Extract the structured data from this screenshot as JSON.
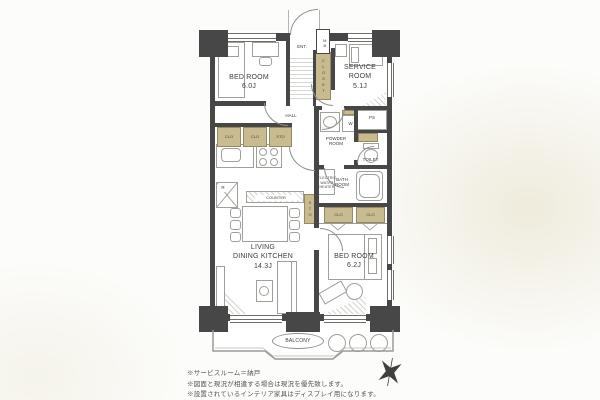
{
  "colors": {
    "wall": "#474747",
    "closet_fill": "#c8bb90",
    "accent_hatch": "#d4d4cf"
  },
  "rooms": {
    "bedroom_top": {
      "label": "BED ROOM",
      "size": "6.0J"
    },
    "service_room": {
      "label": "SERVICE\nROOM",
      "size": "5.1J"
    },
    "ldk": {
      "label": "LIVING\nDINING KITCHEN",
      "size": "14.3J"
    },
    "bedroom_bottom": {
      "label": "BED ROOM",
      "size": "6.2J"
    },
    "entrance": "ENT.",
    "hall": "HALL",
    "powder_room": "POWDER\nROOM",
    "toilet": "TOILET",
    "bath_room": "BATH\nROOM",
    "balcony": "BALCONY"
  },
  "fixtures": {
    "meter_box": "MB",
    "pipe_space": "PS",
    "washing_machine": "W",
    "refrigerator": "R",
    "counter": "COUNTER",
    "electric_water_heater": "ELECTRIC\nWATER\nHEATER",
    "closet": "CLOSET",
    "clo": "CLO",
    "sto": "STO"
  },
  "notes": [
    "※サービスルーム＝納戸",
    "※図面と現況が相違する場合は現況を優先致します。",
    "※設置されているインテリア家具はディスプレイ用になります。"
  ]
}
